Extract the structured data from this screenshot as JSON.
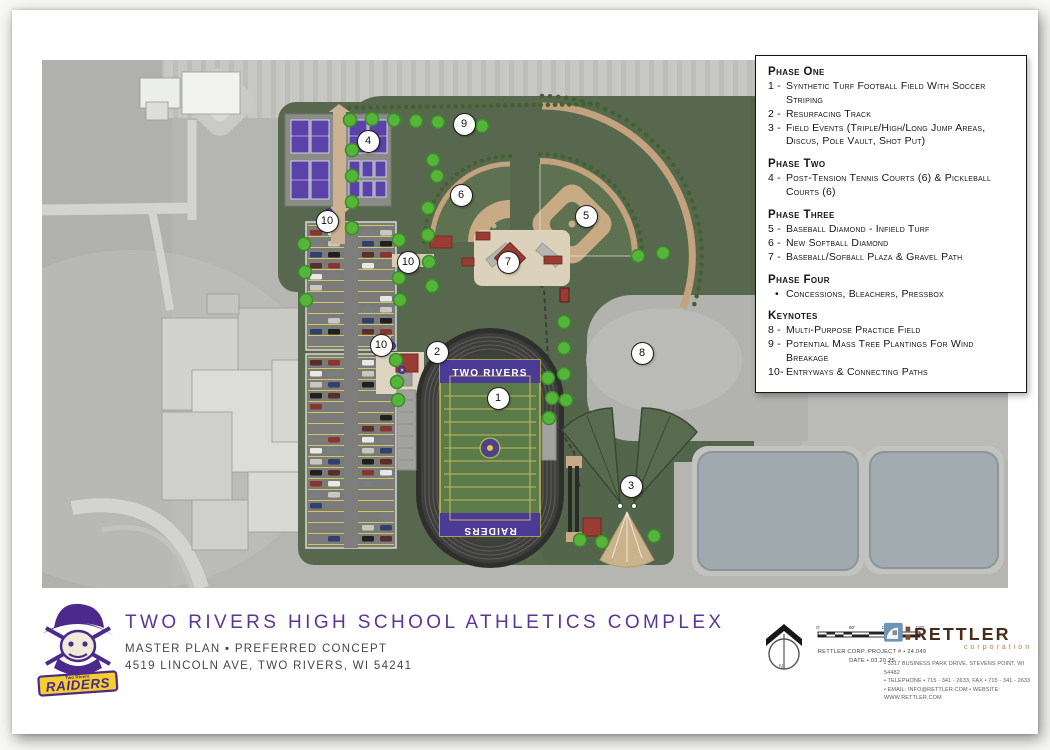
{
  "legend": {
    "sections": [
      {
        "title": "Phase One",
        "items": [
          {
            "k": "1 -",
            "text": "Synthetic Turf Football Field With Soccer Striping"
          },
          {
            "k": "2 -",
            "text": "Resurfacing Track"
          },
          {
            "k": "3 -",
            "text": "Field Events (Triple/High/Long Jump Areas, Discus, Pole Vault, Shot Put)"
          }
        ]
      },
      {
        "title": "Phase Two",
        "items": [
          {
            "k": "4 -",
            "text": "Post-Tension Tennis Courts (6) & Pickleball Courts (6)"
          }
        ]
      },
      {
        "title": "Phase Three",
        "items": [
          {
            "k": "5 -",
            "text": "Baseball Diamond - Infield Turf"
          },
          {
            "k": "6 -",
            "text": "New Softball Diamond"
          },
          {
            "k": "7 -",
            "text": "Baseball/Sofball Plaza & Gravel Path"
          }
        ]
      },
      {
        "title": "Phase Four",
        "items": [
          {
            "k": "•",
            "text": "Concessions, Bleachers, Pressbox"
          }
        ]
      },
      {
        "title": "Keynotes",
        "items": [
          {
            "k": "8 -",
            "text": "Multi-Purpose Practice Field"
          },
          {
            "k": "9 -",
            "text": "Potential Mass Tree Plantings For Wind Breakage"
          },
          {
            "k": "10-",
            "text": "Entryways & Connecting Paths"
          }
        ]
      }
    ]
  },
  "titleblock": {
    "title": "TWO RIVERS HIGH SCHOOL ATHLETICS COMPLEX",
    "subtitle": "MASTER PLAN  ▪  PREFERRED CONCEPT",
    "address": "4519 LINCOLN AVE, TWO RIVERS, WI 54241"
  },
  "logo": {
    "school": "Two Rivers",
    "banner": "RAIDERS"
  },
  "scale": {
    "ticks": [
      "0'",
      "60'",
      "120'",
      "180'"
    ],
    "project_line": "RETTLER CORP. PROJECT # • 24.049",
    "date_line": "DATE • 03.20.25",
    "north_label": "N"
  },
  "firm": {
    "name": "RETTLER",
    "subname": "corporation",
    "lines": [
      "• 3317 BUSINESS PARK DRIVE, STEVENS POINT, WI 54482",
      "• TELEPHONE • 715 - 341 - 2633,  FAX • 715 - 341 - 2633",
      "• EMAIL: INFO@RETTLER.COM • WEBSITE: WWW.RETTLER.COM"
    ]
  },
  "map": {
    "field_text_top": "TWO RIVERS",
    "field_text_bottom": "RAIDERS",
    "markers": [
      {
        "label": "1",
        "x": 455,
        "y": 337
      },
      {
        "label": "2",
        "x": 394,
        "y": 291
      },
      {
        "label": "3",
        "x": 588,
        "y": 425
      },
      {
        "label": "4",
        "x": 325,
        "y": 80
      },
      {
        "label": "5",
        "x": 543,
        "y": 155
      },
      {
        "label": "6",
        "x": 418,
        "y": 134
      },
      {
        "label": "7",
        "x": 465,
        "y": 201
      },
      {
        "label": "8",
        "x": 599,
        "y": 292
      },
      {
        "label": "9",
        "x": 421,
        "y": 63
      },
      {
        "label": "10",
        "x": 284,
        "y": 160
      },
      {
        "label": "10",
        "x": 365,
        "y": 201
      },
      {
        "label": "10",
        "x": 338,
        "y": 284
      }
    ],
    "colors": {
      "site_green": "#57684e",
      "field_green": "#5c7b4b",
      "endzone_purple": "#4c3b96",
      "court_purple": "#5b41aa",
      "path_tan": "#c2a37e",
      "building_red": "#9a3c34",
      "tree_green": "#56b43b",
      "pond_gray": "#a0a9ae",
      "accent_purple": "#5e3494",
      "raiders_yellow": "#f3d02f",
      "rettler_brown": "#4a2a18",
      "rettler_orange": "#c07a40",
      "rettler_blue": "#6e94b8"
    }
  }
}
